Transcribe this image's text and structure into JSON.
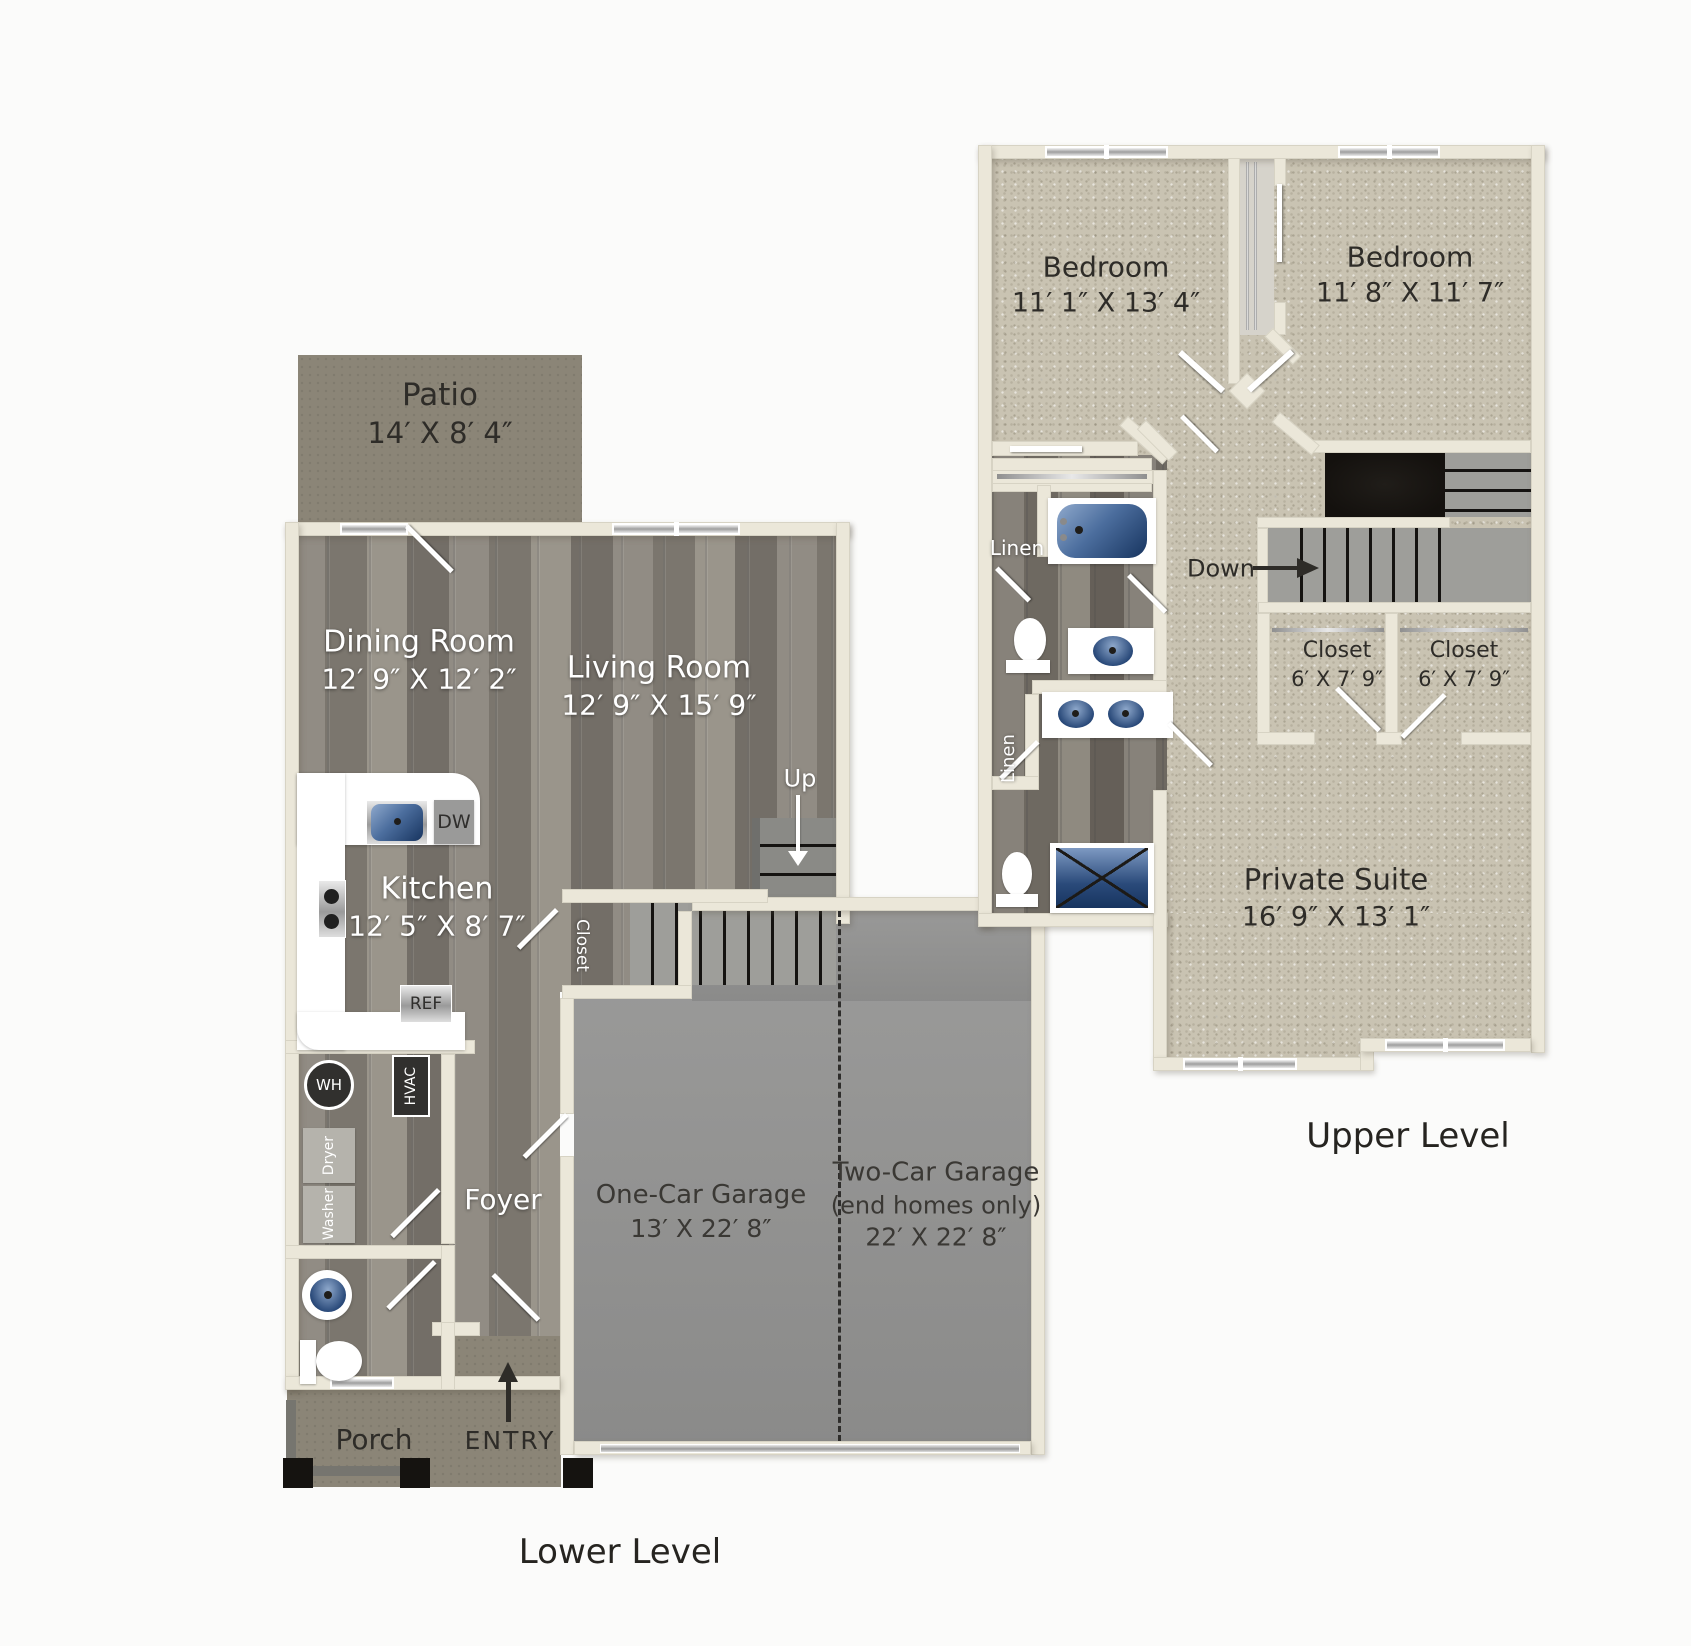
{
  "document": {
    "type": "floor-plan",
    "units": "feet-inches"
  },
  "lower": {
    "level_label": "Lower Level",
    "patio": {
      "name": "Patio",
      "dims": "14′ X 8′ 4″"
    },
    "dining": {
      "name": "Dining Room",
      "dims": "12′ 9″ X 12′ 2″"
    },
    "living": {
      "name": "Living Room",
      "dims": "12′ 9″ X 15′ 9″"
    },
    "kitchen": {
      "name": "Kitchen",
      "dims": "12′ 5″ X 8′ 7″"
    },
    "foyer_label": "Foyer",
    "closet_label": "Closet",
    "up_label": "Up",
    "garage1": {
      "name": "One-Car Garage",
      "dims": "13′ X 22′ 8″"
    },
    "garage2": {
      "name": "Two-Car Garage",
      "note": "(end homes only)",
      "dims": "22′ X 22′ 8″"
    },
    "porch_label": "Porch",
    "entry_label": "ENTRY",
    "appliances": {
      "dw": "DW",
      "ref": "REF",
      "wh": "WH",
      "hvac": "HVAC",
      "dryer": "Dryer",
      "washer": "Washer"
    }
  },
  "upper": {
    "level_label": "Upper Level",
    "bedroom1": {
      "name": "Bedroom",
      "dims": "11′ 1″ X 13′ 4″"
    },
    "bedroom2": {
      "name": "Bedroom",
      "dims": "11′ 8″ X 11′ 7″"
    },
    "suite": {
      "name": "Private Suite",
      "dims": "16′ 9″ X 13′ 1″"
    },
    "closet1": {
      "name": "Closet",
      "dims": "6′ X 7′ 9″"
    },
    "closet2": {
      "name": "Closet",
      "dims": "6′ X 7′ 9″"
    },
    "linen1": "Linen",
    "linen2": "Linen",
    "down_label": "Down"
  },
  "colors": {
    "wall": "#ebe7d9",
    "wood": "#8b867e",
    "carpet": "#c9c3b2",
    "olive": "#8b8577",
    "garage_floor": "#939392",
    "fixture_blue": "#2a4a7a",
    "text_dark": "#2e2c28",
    "text_light": "#ffffff"
  }
}
